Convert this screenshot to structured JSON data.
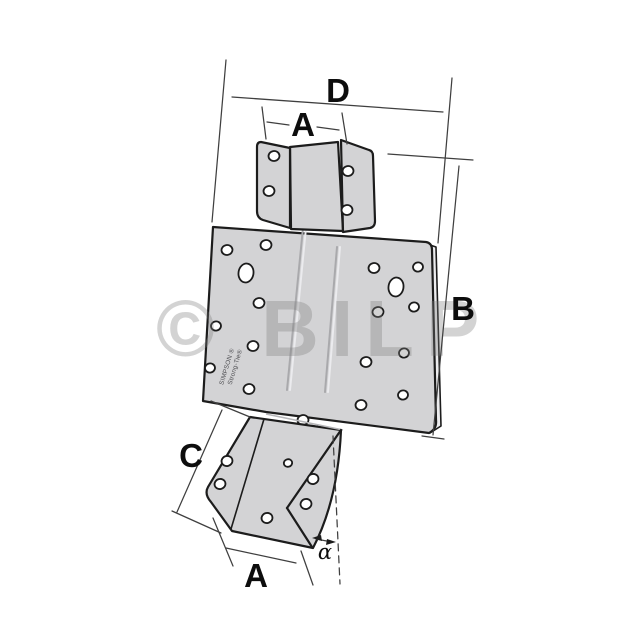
{
  "page": {
    "background": "#ffffff"
  },
  "watermark": {
    "text": "© BILP"
  },
  "part": {
    "fill": "#d3d3d5",
    "strip_fill": "#ececee",
    "outline": "#1c1c1c",
    "brand_line1": "SIMPSON ®",
    "brand_line2": "Strong-Tie®"
  },
  "labels": {
    "top_width": "D",
    "top_flange_width": "A",
    "height": "B",
    "seat_flange_length": "C",
    "bottom_width": "A",
    "angle": "α"
  }
}
